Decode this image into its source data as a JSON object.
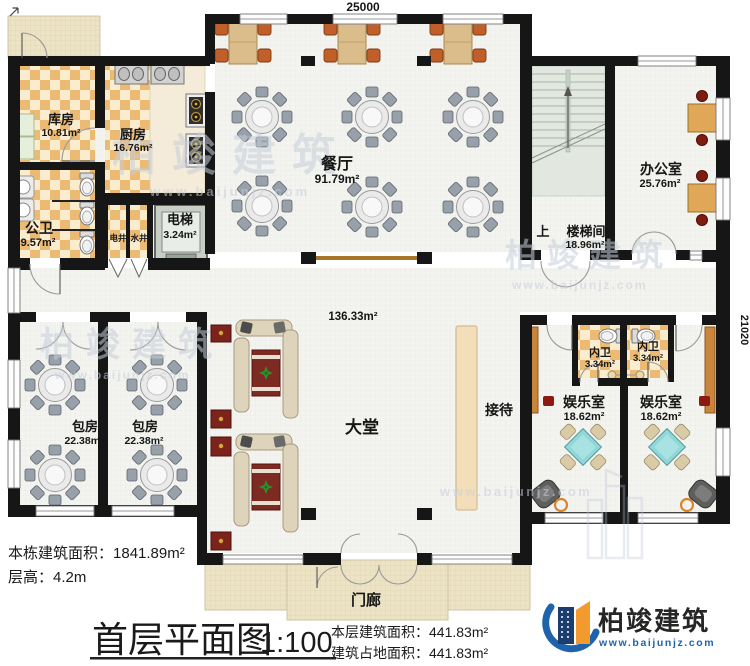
{
  "dimensions": {
    "top": "25000",
    "right": "21020"
  },
  "rooms": {
    "storage": {
      "name": "库房",
      "area": "10.81m²"
    },
    "kitchen": {
      "name": "厨房",
      "area": "16.76m²"
    },
    "public_wc": {
      "name": "公卫",
      "area": "9.57m²"
    },
    "elec_shaft": {
      "name": "电井"
    },
    "water_shaft": {
      "name": "水井"
    },
    "elevator": {
      "name": "电梯",
      "area": "3.24m²"
    },
    "dining": {
      "name": "餐厅",
      "area": "91.79m²"
    },
    "stairwell": {
      "name": "楼梯间",
      "area": "18.96m²",
      "up_label": "上"
    },
    "office": {
      "name": "办公室",
      "area": "25.76m²"
    },
    "lobby": {
      "name": "大堂",
      "area": "136.33m²"
    },
    "reception": {
      "name": "接待"
    },
    "private_room_1": {
      "name": "包房",
      "area": "22.38m²"
    },
    "private_room_2": {
      "name": "包房",
      "area": "22.38m²"
    },
    "inner_wc_1": {
      "name": "内卫",
      "area": "3.34m²"
    },
    "inner_wc_2": {
      "name": "内卫",
      "area": "3.34m²"
    },
    "rec_room_1": {
      "name": "娱乐室",
      "area": "18.62m²"
    },
    "rec_room_2": {
      "name": "娱乐室",
      "area": "18.62m²"
    },
    "porch": {
      "name": "门廊"
    }
  },
  "annotations": {
    "building_total_area_label": "本栋建筑面积：",
    "building_total_area_value": "1841.89m²",
    "floor_height_label": "层高：",
    "floor_height_value": "4.2m",
    "title": "首层平面图",
    "scale": "1:100",
    "floor_area_label": "本层建筑面积：",
    "floor_area_value": "441.83m²",
    "footprint_area_label": "建筑占地面积：",
    "footprint_area_value": "441.83m²"
  },
  "logo": {
    "company": "柏竣建筑",
    "website": "www.baijunjz.com"
  },
  "watermark": {
    "text": "柏竣建筑",
    "website": "www.baijunjz.com"
  },
  "colors": {
    "wall": "#161616",
    "tile_dark": "#ecba72",
    "tile_light": "#f9eccf",
    "floor": "#f3f3f0",
    "porch": "#ece3c5",
    "wood_table": "#dabd8b",
    "chair_orange": "#c05f2a",
    "game_table_teal": "#92d7d7",
    "rug_red": "#7c2a22",
    "logo_blue": "#1f63ad",
    "logo_orange": "#f29a2e"
  }
}
